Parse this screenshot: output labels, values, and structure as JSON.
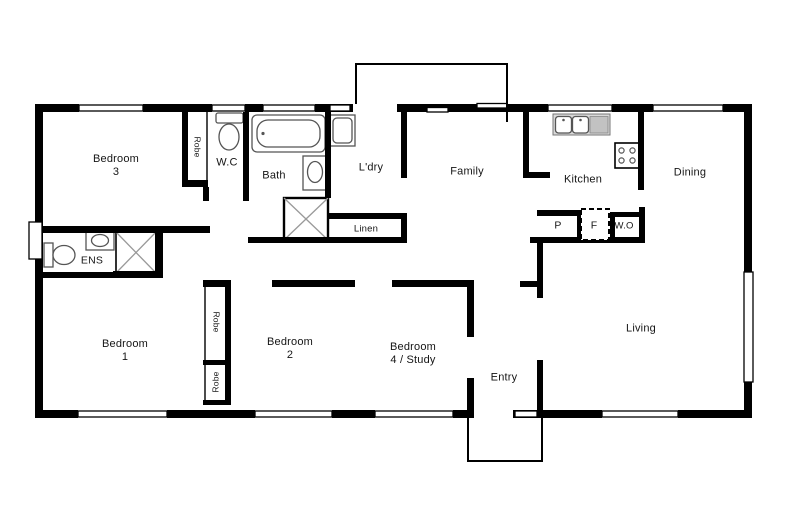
{
  "plan": {
    "canvas": {
      "width": 790,
      "height": 527,
      "background": "#ffffff"
    },
    "colors": {
      "wall": "#000000",
      "fixture_stroke": "#555555",
      "shower_cross": "#999999",
      "counter_fill": "#d9d9d9",
      "drainer_fill": "#c2c2c2",
      "text": "#151515"
    },
    "labels": [
      {
        "id": "bedroom-3",
        "lines": [
          "Bedroom",
          "3"
        ],
        "x": 116,
        "y": 166
      },
      {
        "id": "robe-bed3",
        "lines": [
          "Robe"
        ],
        "x": 197,
        "y": 147,
        "rotate": 90,
        "size": 8.5
      },
      {
        "id": "wc",
        "lines": [
          "W.C"
        ],
        "x": 227,
        "y": 163
      },
      {
        "id": "bath",
        "lines": [
          "Bath"
        ],
        "x": 274,
        "y": 176
      },
      {
        "id": "laundry",
        "lines": [
          "L'dry"
        ],
        "x": 371,
        "y": 168
      },
      {
        "id": "family",
        "lines": [
          "Family"
        ],
        "x": 467,
        "y": 172
      },
      {
        "id": "kitchen",
        "lines": [
          "Kitchen"
        ],
        "x": 583,
        "y": 180
      },
      {
        "id": "dining",
        "lines": [
          "Dining"
        ],
        "x": 690,
        "y": 173
      },
      {
        "id": "linen",
        "lines": [
          "Linen"
        ],
        "x": 366,
        "y": 229,
        "size": 9.5
      },
      {
        "id": "pantry",
        "lines": [
          "P"
        ],
        "x": 558,
        "y": 226,
        "size": 10.5
      },
      {
        "id": "fridge",
        "lines": [
          "F"
        ],
        "x": 594,
        "y": 226,
        "size": 10.5
      },
      {
        "id": "wall-oven",
        "lines": [
          "W.O"
        ],
        "x": 624,
        "y": 226,
        "size": 9.5
      },
      {
        "id": "ensuite",
        "lines": [
          "ENS"
        ],
        "x": 92,
        "y": 261,
        "size": 10.5
      },
      {
        "id": "bedroom-1",
        "lines": [
          "Bedroom",
          "1"
        ],
        "x": 125,
        "y": 351
      },
      {
        "id": "robe-upper",
        "lines": [
          "Robe"
        ],
        "x": 216,
        "y": 322,
        "rotate": 90,
        "size": 8.5
      },
      {
        "id": "robe-lower",
        "lines": [
          "Robe"
        ],
        "x": 216,
        "y": 382,
        "rotate": -90,
        "size": 8.5
      },
      {
        "id": "bedroom-2",
        "lines": [
          "Bedroom",
          "2"
        ],
        "x": 290,
        "y": 349
      },
      {
        "id": "bedroom-4",
        "lines": [
          "Bedroom",
          "4 / Study"
        ],
        "x": 413,
        "y": 354
      },
      {
        "id": "entry",
        "lines": [
          "Entry"
        ],
        "x": 504,
        "y": 378
      },
      {
        "id": "living",
        "lines": [
          "Living"
        ],
        "x": 641,
        "y": 329
      }
    ],
    "shapes": [
      {
        "id": "robe-bed3-box",
        "type": "rect",
        "x": 186,
        "y": 110,
        "w": 21,
        "h": 74,
        "cls": "thinbox"
      },
      {
        "id": "robe-upper-box",
        "type": "rect",
        "x": 205,
        "y": 285,
        "w": 22,
        "h": 77,
        "cls": "thinbox"
      },
      {
        "id": "robe-lower-box",
        "type": "rect",
        "x": 205,
        "y": 363,
        "w": 22,
        "h": 39,
        "cls": "thinbox"
      },
      {
        "id": "wc-toilet-cistern",
        "type": "rect",
        "x": 216,
        "y": 113,
        "w": 27,
        "h": 10,
        "rx": 2,
        "cls": "fix"
      },
      {
        "id": "wc-toilet-bowl",
        "type": "ellipse",
        "cx": 229,
        "cy": 137,
        "rx": 10,
        "ry": 13,
        "cls": "fix"
      },
      {
        "id": "bathtub-outer",
        "type": "rect",
        "x": 252,
        "y": 115,
        "w": 73,
        "h": 37,
        "rx": 5,
        "cls": "fix"
      },
      {
        "id": "bathtub-inner",
        "type": "rect",
        "x": 257,
        "y": 120,
        "w": 63,
        "h": 27,
        "rx": 11,
        "cls": "fix"
      },
      {
        "id": "bathtub-tap",
        "type": "circle",
        "cx": 263,
        "cy": 133.5,
        "r": 1.6,
        "cls": "fixdot"
      },
      {
        "id": "bath-vanity",
        "type": "rect",
        "x": 303,
        "y": 156,
        "w": 24,
        "h": 34,
        "cls": "fix"
      },
      {
        "id": "bath-basin",
        "type": "ellipse",
        "cx": 315,
        "cy": 172,
        "rx": 7.5,
        "ry": 10.5,
        "cls": "fix"
      },
      {
        "id": "bath-shower-box",
        "type": "rect",
        "x": 284,
        "y": 198,
        "w": 44,
        "h": 42,
        "cls": "fixstrong"
      },
      {
        "id": "bath-shower-cross-1",
        "type": "line",
        "x1": 284,
        "y1": 198,
        "x2": 328,
        "y2": 240,
        "cls": "cross"
      },
      {
        "id": "bath-shower-cross-2",
        "type": "line",
        "x1": 328,
        "y1": 198,
        "x2": 284,
        "y2": 240,
        "cls": "cross"
      },
      {
        "id": "laundry-tub-outer",
        "type": "rect",
        "x": 330,
        "y": 115,
        "w": 25,
        "h": 31,
        "cls": "fix"
      },
      {
        "id": "laundry-tub-inner",
        "type": "rect",
        "x": 333,
        "y": 118,
        "w": 19,
        "h": 25,
        "rx": 4,
        "cls": "fix"
      },
      {
        "id": "kitchen-counter",
        "type": "rect",
        "x": 553,
        "y": 114,
        "w": 57,
        "h": 21,
        "cls": "counter"
      },
      {
        "id": "kitchen-drainer",
        "type": "rect",
        "x": 590,
        "y": 116.5,
        "w": 18,
        "h": 16.5,
        "cls": "drainer"
      },
      {
        "id": "kitchen-sink-1",
        "type": "rect",
        "x": 555.5,
        "y": 116.5,
        "w": 16,
        "h": 16.5,
        "rx": 3,
        "cls": "fix"
      },
      {
        "id": "kitchen-sink-2",
        "type": "rect",
        "x": 572.5,
        "y": 116.5,
        "w": 16,
        "h": 16.5,
        "rx": 3,
        "cls": "fix"
      },
      {
        "id": "kitchen-tap-1",
        "type": "circle",
        "cx": 563.5,
        "cy": 120,
        "r": 1.3,
        "cls": "fixdot"
      },
      {
        "id": "kitchen-tap-2",
        "type": "circle",
        "cx": 580.5,
        "cy": 120,
        "r": 1.3,
        "cls": "fixdot"
      },
      {
        "id": "cooktop",
        "type": "rect",
        "x": 615,
        "y": 143,
        "w": 24,
        "h": 25,
        "cls": "fixstrong2"
      },
      {
        "id": "cooktop-burner-1",
        "type": "circle",
        "cx": 621.5,
        "cy": 150.5,
        "r": 2.6,
        "cls": "burner"
      },
      {
        "id": "cooktop-burner-2",
        "type": "circle",
        "cx": 632.5,
        "cy": 150.5,
        "r": 2.6,
        "cls": "burner"
      },
      {
        "id": "cooktop-burner-3",
        "type": "circle",
        "cx": 621.5,
        "cy": 160.5,
        "r": 2.6,
        "cls": "burner"
      },
      {
        "id": "cooktop-burner-4",
        "type": "circle",
        "cx": 632.5,
        "cy": 160.5,
        "r": 2.6,
        "cls": "burner"
      },
      {
        "id": "ens-toilet-cistern",
        "type": "rect",
        "x": 44,
        "y": 243,
        "w": 9,
        "h": 24,
        "cls": "fix"
      },
      {
        "id": "ens-toilet-bowl",
        "type": "ellipse",
        "cx": 64,
        "cy": 255,
        "rx": 11,
        "ry": 9.5,
        "cls": "fix"
      },
      {
        "id": "ens-vanity",
        "type": "rect",
        "x": 86,
        "y": 231,
        "w": 28,
        "h": 19,
        "cls": "fix"
      },
      {
        "id": "ens-basin",
        "type": "ellipse",
        "cx": 100,
        "cy": 240.5,
        "rx": 8.5,
        "ry": 6,
        "cls": "fix"
      },
      {
        "id": "ens-shower-box",
        "type": "rect",
        "x": 116,
        "y": 232,
        "w": 40,
        "h": 41,
        "cls": "fixstrong2"
      },
      {
        "id": "ens-shower-cross-1",
        "type": "line",
        "x1": 116,
        "y1": 232,
        "x2": 156,
        "y2": 273,
        "cls": "cross"
      },
      {
        "id": "ens-shower-cross-2",
        "type": "line",
        "x1": 156,
        "y1": 232,
        "x2": 116,
        "y2": 273,
        "cls": "cross"
      },
      {
        "id": "wall-top-1",
        "type": "rect",
        "x": 35,
        "y": 104,
        "w": 44,
        "h": 8,
        "cls": "wall"
      },
      {
        "id": "wall-top-2",
        "type": "rect",
        "x": 143,
        "y": 104,
        "w": 69,
        "h": 8,
        "cls": "wall"
      },
      {
        "id": "wall-top-3",
        "type": "rect",
        "x": 245,
        "y": 104,
        "w": 18,
        "h": 8,
        "cls": "wall"
      },
      {
        "id": "wall-top-4",
        "type": "rect",
        "x": 315,
        "y": 104,
        "w": 38,
        "h": 8,
        "cls": "wall"
      },
      {
        "id": "wall-top-5",
        "type": "rect",
        "x": 397,
        "y": 104,
        "w": 151,
        "h": 8,
        "cls": "wall"
      },
      {
        "id": "wall-top-6",
        "type": "rect",
        "x": 612,
        "y": 104,
        "w": 41,
        "h": 8,
        "cls": "wall"
      },
      {
        "id": "wall-top-7",
        "type": "rect",
        "x": 723,
        "y": 104,
        "w": 29,
        "h": 8,
        "cls": "wall"
      },
      {
        "id": "wall-bottom-1",
        "type": "rect",
        "x": 35,
        "y": 410,
        "w": 43,
        "h": 8,
        "cls": "wall"
      },
      {
        "id": "wall-bottom-2",
        "type": "rect",
        "x": 167,
        "y": 410,
        "w": 88,
        "h": 8,
        "cls": "wall"
      },
      {
        "id": "wall-bottom-3",
        "type": "rect",
        "x": 332,
        "y": 410,
        "w": 43,
        "h": 8,
        "cls": "wall"
      },
      {
        "id": "wall-bottom-4",
        "type": "rect",
        "x": 453,
        "y": 410,
        "w": 15,
        "h": 8,
        "cls": "wall"
      },
      {
        "id": "wall-bottom-5",
        "type": "rect",
        "x": 513,
        "y": 410,
        "w": 89,
        "h": 8,
        "cls": "wall"
      },
      {
        "id": "wall-bottom-6",
        "type": "rect",
        "x": 678,
        "y": 410,
        "w": 74,
        "h": 8,
        "cls": "wall"
      },
      {
        "id": "wall-left",
        "type": "rect",
        "x": 35,
        "y": 104,
        "w": 8,
        "h": 314,
        "cls": "wall"
      },
      {
        "id": "wall-right",
        "type": "rect",
        "x": 744,
        "y": 104,
        "w": 8,
        "h": 314,
        "cls": "wall"
      },
      {
        "id": "wall-robe3-left",
        "type": "rect",
        "x": 182,
        "y": 108,
        "w": 6,
        "h": 79,
        "cls": "wall"
      },
      {
        "id": "wall-robe3-bottom",
        "type": "rect",
        "x": 182,
        "y": 180,
        "w": 26,
        "h": 7,
        "cls": "wall"
      },
      {
        "id": "wall-wc-bath",
        "type": "rect",
        "x": 243,
        "y": 112,
        "w": 6,
        "h": 89,
        "cls": "wall"
      },
      {
        "id": "wall-wc-jamb",
        "type": "rect",
        "x": 203,
        "y": 187,
        "w": 6,
        "h": 14,
        "cls": "wall"
      },
      {
        "id": "wall-bath-ldry",
        "type": "rect",
        "x": 325,
        "y": 112,
        "w": 6,
        "h": 86,
        "cls": "wall"
      },
      {
        "id": "wall-hall",
        "type": "rect",
        "x": 248,
        "y": 237,
        "w": 159,
        "h": 6,
        "cls": "wall"
      },
      {
        "id": "wall-linen-top",
        "type": "rect",
        "x": 327,
        "y": 213,
        "w": 80,
        "h": 6,
        "cls": "wall"
      },
      {
        "id": "wall-linen-right",
        "type": "rect",
        "x": 401,
        "y": 213,
        "w": 6,
        "h": 30,
        "cls": "wall"
      },
      {
        "id": "wall-ldry-family",
        "type": "rect",
        "x": 401,
        "y": 112,
        "w": 6,
        "h": 66,
        "cls": "wall"
      },
      {
        "id": "wall-family-kitchen",
        "type": "rect",
        "x": 523,
        "y": 112,
        "w": 6,
        "h": 66,
        "cls": "wall"
      },
      {
        "id": "wall-kitchen-return",
        "type": "rect",
        "x": 523,
        "y": 172,
        "w": 27,
        "h": 6,
        "cls": "wall"
      },
      {
        "id": "wall-kitchen-dining",
        "type": "rect",
        "x": 638,
        "y": 112,
        "w": 6,
        "h": 78,
        "cls": "wall"
      },
      {
        "id": "wall-bench-top",
        "type": "rect",
        "x": 537,
        "y": 210,
        "w": 43,
        "h": 6,
        "cls": "wall"
      },
      {
        "id": "wall-bench-divider",
        "type": "rect",
        "x": 577,
        "y": 210,
        "w": 6,
        "h": 33,
        "cls": "wall"
      },
      {
        "id": "wall-wo-top",
        "type": "rect",
        "x": 610,
        "y": 212,
        "w": 30,
        "h": 5,
        "cls": "wall"
      },
      {
        "id": "wall-wo-left",
        "type": "rect",
        "x": 610,
        "y": 212,
        "w": 5,
        "h": 31,
        "cls": "wall"
      },
      {
        "id": "wall-wo-right",
        "type": "rect",
        "x": 639,
        "y": 207,
        "w": 6,
        "h": 36,
        "cls": "wall"
      },
      {
        "id": "wall-bench-bottom",
        "type": "rect",
        "x": 530,
        "y": 237,
        "w": 115,
        "h": 6,
        "cls": "wall"
      },
      {
        "id": "wall-entry-upper",
        "type": "rect",
        "x": 537,
        "y": 237,
        "w": 6,
        "h": 61,
        "cls": "wall"
      },
      {
        "id": "wall-entry-stub",
        "type": "rect",
        "x": 520,
        "y": 281,
        "w": 17,
        "h": 6,
        "cls": "wall"
      },
      {
        "id": "wall-entry-lower",
        "type": "rect",
        "x": 537,
        "y": 360,
        "w": 6,
        "h": 58,
        "cls": "wall"
      },
      {
        "id": "wall-bed4-top",
        "type": "rect",
        "x": 392,
        "y": 280,
        "w": 81,
        "h": 7,
        "cls": "wall"
      },
      {
        "id": "wall-bed4-right-up",
        "type": "rect",
        "x": 467,
        "y": 280,
        "w": 7,
        "h": 57,
        "cls": "wall"
      },
      {
        "id": "wall-bed4-right-low",
        "type": "rect",
        "x": 467,
        "y": 378,
        "w": 7,
        "h": 40,
        "cls": "wall"
      },
      {
        "id": "wall-bed2-top",
        "type": "rect",
        "x": 272,
        "y": 280,
        "w": 83,
        "h": 7,
        "cls": "wall"
      },
      {
        "id": "wall-robe12-top",
        "type": "rect",
        "x": 203,
        "y": 280,
        "w": 28,
        "h": 7,
        "cls": "wall"
      },
      {
        "id": "wall-robe12-right",
        "type": "rect",
        "x": 225,
        "y": 280,
        "w": 6,
        "h": 125,
        "cls": "wall"
      },
      {
        "id": "wall-robe12-divider",
        "type": "rect",
        "x": 203,
        "y": 360,
        "w": 28,
        "h": 5,
        "cls": "wall"
      },
      {
        "id": "wall-robe12-bottom",
        "type": "rect",
        "x": 203,
        "y": 400,
        "w": 28,
        "h": 5,
        "cls": "wall"
      },
      {
        "id": "wall-bed3-bottom",
        "type": "rect",
        "x": 35,
        "y": 226,
        "w": 175,
        "h": 7,
        "cls": "wall"
      },
      {
        "id": "wall-ens-bottom",
        "type": "rect",
        "x": 43,
        "y": 272,
        "w": 72,
        "h": 6,
        "cls": "wall"
      },
      {
        "id": "wall-ens-shower-bot",
        "type": "rect",
        "x": 113,
        "y": 271,
        "w": 50,
        "h": 7,
        "cls": "wall"
      },
      {
        "id": "wall-ens-shower-rt",
        "type": "rect",
        "x": 155,
        "y": 232,
        "w": 8,
        "h": 45,
        "cls": "wall"
      },
      {
        "id": "window-bed3",
        "type": "rect",
        "x": 79,
        "y": 105,
        "w": 64,
        "h": 6,
        "cls": "window"
      },
      {
        "id": "window-wc",
        "type": "rect",
        "x": 212,
        "y": 105,
        "w": 33,
        "h": 6,
        "cls": "window"
      },
      {
        "id": "window-bath",
        "type": "rect",
        "x": 263,
        "y": 105,
        "w": 52,
        "h": 6,
        "cls": "window"
      },
      {
        "id": "window-ldry",
        "type": "rect",
        "x": 330,
        "y": 105,
        "w": 20,
        "h": 6,
        "cls": "window"
      },
      {
        "id": "window-family-1",
        "type": "rect",
        "x": 427,
        "y": 107.5,
        "w": 21,
        "h": 4.5,
        "cls": "window"
      },
      {
        "id": "window-family-2",
        "type": "rect",
        "x": 477,
        "y": 103.5,
        "w": 30,
        "h": 4.5,
        "cls": "window"
      },
      {
        "id": "window-kitchen",
        "type": "rect",
        "x": 548,
        "y": 105,
        "w": 64,
        "h": 6,
        "cls": "window"
      },
      {
        "id": "window-dining",
        "type": "rect",
        "x": 653,
        "y": 105,
        "w": 70,
        "h": 6,
        "cls": "window"
      },
      {
        "id": "window-bed1",
        "type": "rect",
        "x": 78,
        "y": 411,
        "w": 89,
        "h": 6,
        "cls": "window"
      },
      {
        "id": "window-bed2",
        "type": "rect",
        "x": 255,
        "y": 411,
        "w": 77,
        "h": 6,
        "cls": "window"
      },
      {
        "id": "window-bed4",
        "type": "rect",
        "x": 375,
        "y": 411,
        "w": 78,
        "h": 6,
        "cls": "window"
      },
      {
        "id": "window-entry-side",
        "type": "rect",
        "x": 515,
        "y": 411,
        "w": 22,
        "h": 6,
        "cls": "window"
      },
      {
        "id": "window-living-bottom",
        "type": "rect",
        "x": 602,
        "y": 411,
        "w": 76,
        "h": 6,
        "cls": "window"
      },
      {
        "id": "window-ens",
        "type": "rect",
        "x": 29,
        "y": 222,
        "w": 13,
        "h": 37,
        "cls": "window"
      },
      {
        "id": "window-living-right",
        "type": "rect",
        "x": 744,
        "y": 272,
        "w": 9,
        "h": 110,
        "cls": "window"
      },
      {
        "id": "fridge-box",
        "type": "rect",
        "x": 581,
        "y": 209,
        "w": 28,
        "h": 31,
        "cls": "dashed"
      },
      {
        "id": "pergola-outline",
        "type": "poly",
        "points": "356,104 356,64 507,64 507,122",
        "cls": "outline"
      },
      {
        "id": "porch-outline",
        "type": "poly",
        "points": "468,418 468,461 542,461 542,418",
        "cls": "outline"
      }
    ]
  }
}
